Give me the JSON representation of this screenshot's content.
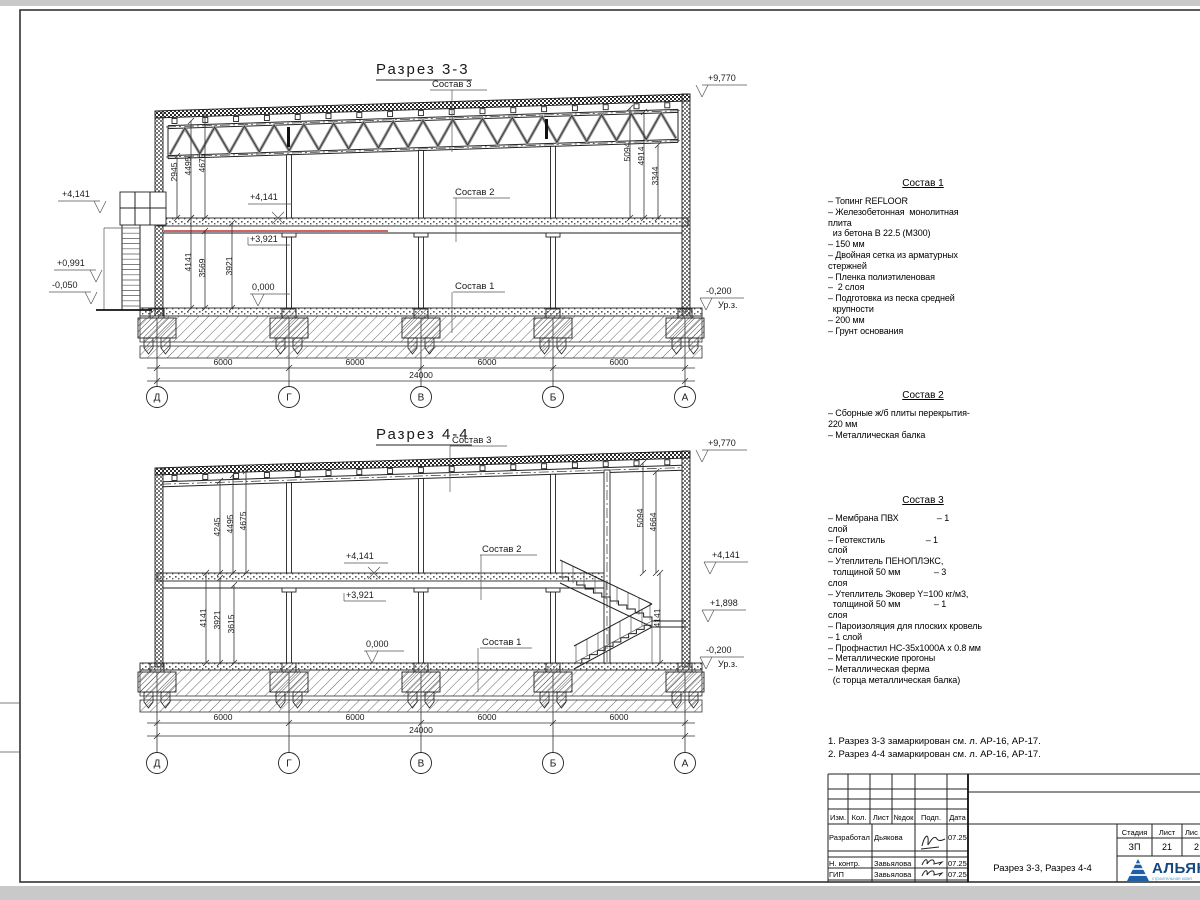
{
  "sections": {
    "s33": {
      "title": "Разрез 3-3",
      "labels": {
        "sostav1": "Состав 1",
        "sostav2": "Состав 2",
        "sostav3": "Состав 3"
      },
      "elev": {
        "roof": "+9,770",
        "floor": "+4,141",
        "floor2": "+3,921",
        "zero": "0,000",
        "ground": "-0,200",
        "ground_lbl": "Ур.з.",
        "out_top": "+4,141",
        "out_mid": "+0,991",
        "out_low": "-0,050"
      },
      "dims_up": [
        "2945",
        "4495",
        "4675"
      ],
      "dims_low": [
        "4141",
        "3569",
        "3921"
      ],
      "dims_right": [
        "5094",
        "4914",
        "3344"
      ]
    },
    "s44": {
      "title": "Разрез 4-4",
      "labels": {
        "sostav1": "Состав 1",
        "sostav2": "Состав 2",
        "sostav3": "Состав 3"
      },
      "elev": {
        "roof": "+9,770",
        "floor": "+4,141",
        "floor2": "+3,921",
        "zero": "0,000",
        "ground": "-0,200",
        "ground_lbl": "Ур.з.",
        "out_floor": "+4,141",
        "out_mid": "+1,898"
      },
      "dims_up": [
        "4245",
        "4495",
        "4675"
      ],
      "dims_low": [
        "4141",
        "3921",
        "3615"
      ],
      "dims_right": [
        "5094",
        "4664"
      ],
      "dim_stair": "4141"
    }
  },
  "grid": {
    "letters": [
      "Д",
      "Г",
      "В",
      "Б",
      "А"
    ],
    "spans": [
      "6000",
      "6000",
      "6000",
      "6000"
    ],
    "total": "24000"
  },
  "sostav_blocks": [
    {
      "title": "Состав 1",
      "lines": [
        "– Топинг REFLOOR",
        "– Железобетонная  монолитная",
        "плита",
        "  из бетона В 22.5 (М300)",
        "– 150 мм",
        "– Двойная сетка из арматурных",
        "стержней",
        "– Пленка полиэтиленовая",
        "–  2 слоя",
        "– Подготовка из песка средней",
        "  крупности",
        "– 200 мм",
        "– Грунт основания"
      ]
    },
    {
      "title": "Состав 2",
      "lines": [
        "– Сборные ж/б плиты перекрытия-",
        "220 мм",
        "– Металлическая балка"
      ]
    },
    {
      "title": "Состав 3",
      "lines": [
        "– Мембрана ПВХ                – 1",
        "слой",
        "– Геотекстиль                 – 1",
        "слой",
        "– Утеплитель ПЕНОПЛЭКС,",
        "  толщиной 50 мм              – 3",
        "слоя",
        "– Утеплитель Эковер Y=100 кг/м3,",
        "  толщиной 50 мм              – 1",
        "слоя",
        "– Пароизоляция для плоских кровель",
        "– 1 слой",
        "– Профнастил НС-35х1000А х 0.8 мм",
        "– Металлические прогоны",
        "– Металлическая ферма",
        "  (с торца металлическая балка)"
      ]
    }
  ],
  "notes": [
    "1. Разрез 3-3 замаркирован см. л. АР-16, АР-17.",
    "2. Разрез 4-4 замаркирован см. л. АР-16, АР-17."
  ],
  "titleblock": {
    "cols": [
      "Изм.",
      "Кол.",
      "Лист",
      "№док",
      "Подп.",
      "Дата"
    ],
    "rows": [
      {
        "role": "Разработал",
        "name": "Дьякова",
        "date": "07.25"
      },
      {
        "role": "Н. контр.",
        "name": "Завьялова",
        "date": "07.25"
      },
      {
        "role": "ГИП",
        "name": "Завьялова",
        "date": "07.25"
      }
    ],
    "stage_lbl": "Стадия",
    "sheet_lbl": "Лист",
    "sheets_lbl": "Лис",
    "stage": "ЗП",
    "sheet": "21",
    "sheets": "2",
    "doc_title": "Разрез 3-3, Разрез 4-4",
    "brand": "АЛЬЯН",
    "brand_sub": "строительная комп"
  }
}
